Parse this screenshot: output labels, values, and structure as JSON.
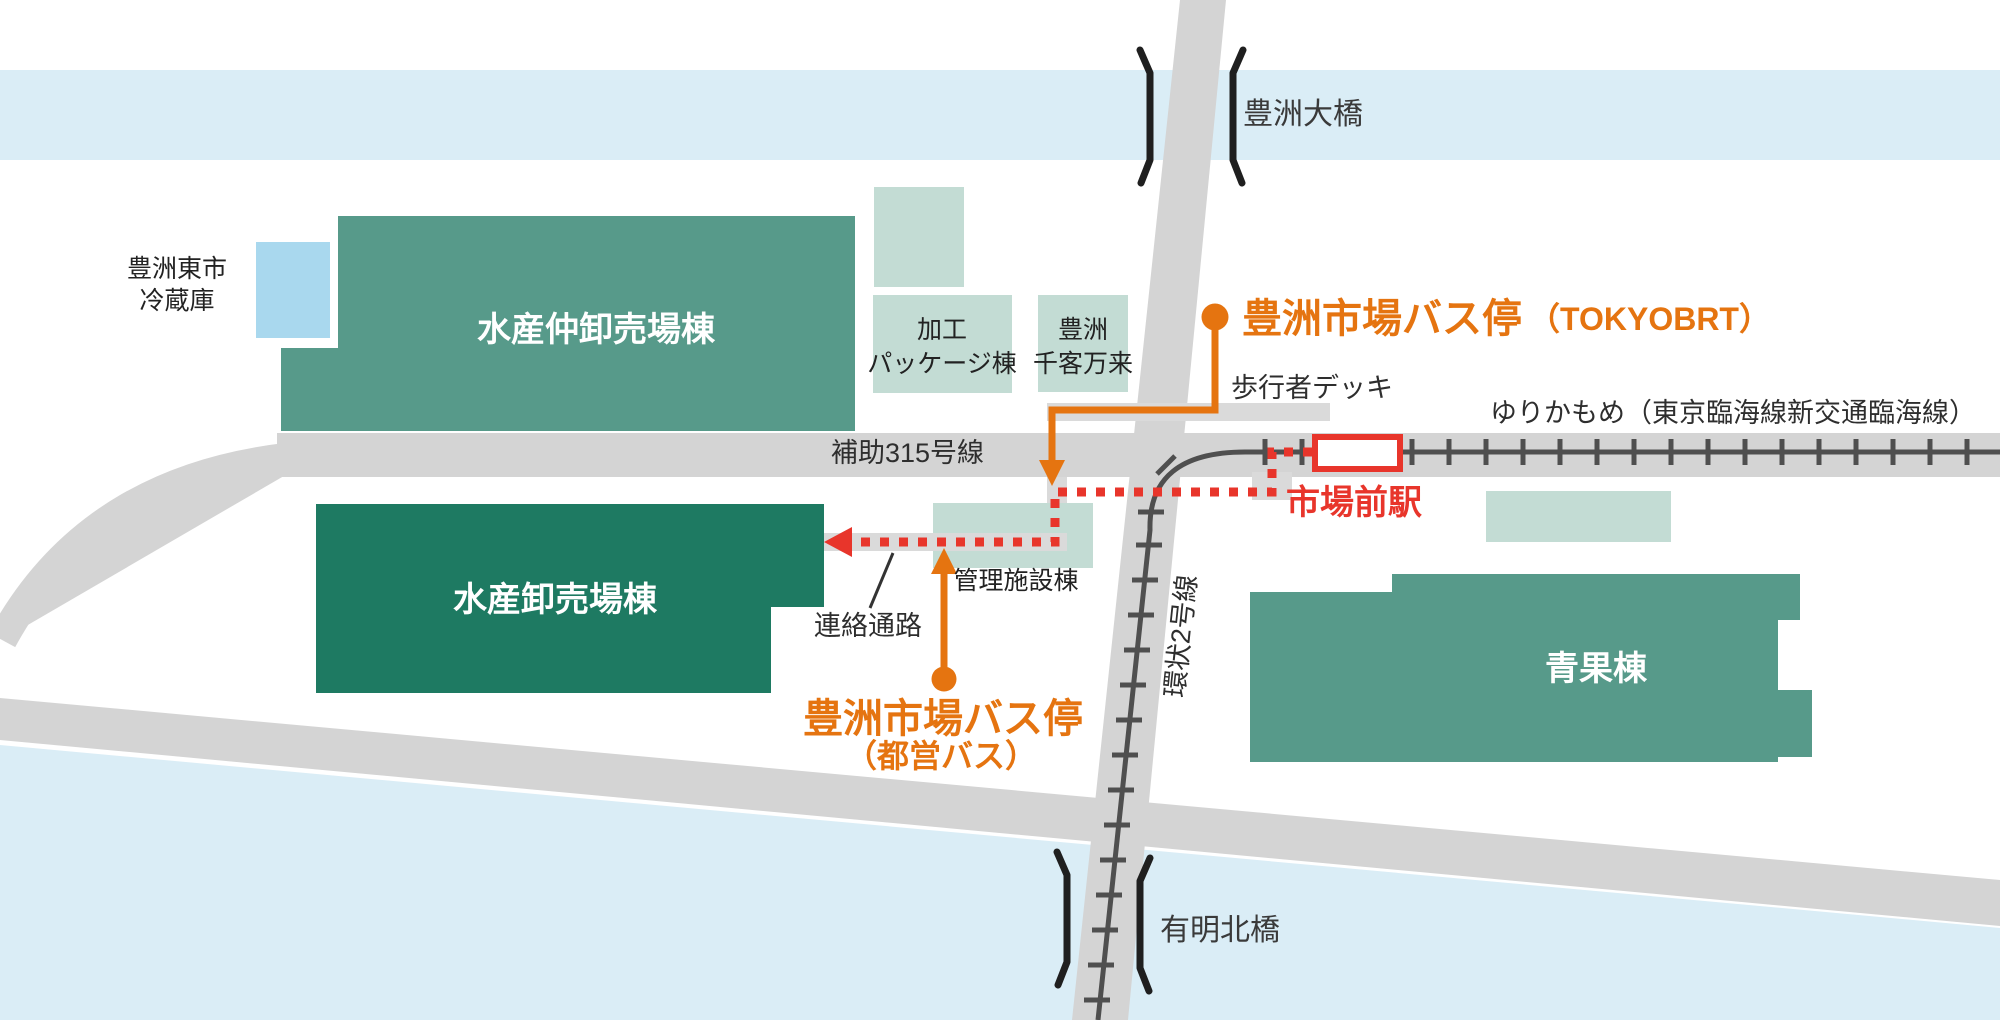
{
  "map_title": "豊洲市場 アクセスマップ",
  "labels": {
    "toyosu_ohashi": "豊洲大橋",
    "reizoko_l1": "豊洲東市",
    "reizoko_l2": "冷蔵庫",
    "nakaoroshi": "水産仲卸売場棟",
    "kako_l1": "加工",
    "kako_l2": "パッケージ棟",
    "senkyaku_l1": "豊洲",
    "senkyaku_l2": "千客万来",
    "brt_stop_main": "豊洲市場バス停",
    "brt_stop_sub": "（TOKYOBRT）",
    "deck": "歩行者デッキ",
    "yurikamome": "ゆりかもめ（東京臨海線新交通臨海線）",
    "hojo315": "補助315号線",
    "shijomae_station": "市場前駅",
    "kanri": "管理施設棟",
    "oroshiuri": "水産卸売場棟",
    "renraku": "連絡通路",
    "toei_stop_main": "豊洲市場バス停",
    "toei_stop_sub": "（都営バス）",
    "kanjo2": "環状2号線",
    "seika": "青果棟",
    "ariake_kitabashi": "有明北橋"
  },
  "colors": {
    "water": "#daedf6",
    "road": "#d4d4d4",
    "pedestrian_deck": "#dadada",
    "railway": "#4f4f4f",
    "building_green": "#579a8a",
    "building_dark_green": "#1e7a62",
    "building_light_green": "#c3dcd4",
    "building_light_blue": "#a9d8ee",
    "route_red": "#e8352b",
    "bus_orange": "#e57410",
    "text_black": "#2e2e2e"
  }
}
